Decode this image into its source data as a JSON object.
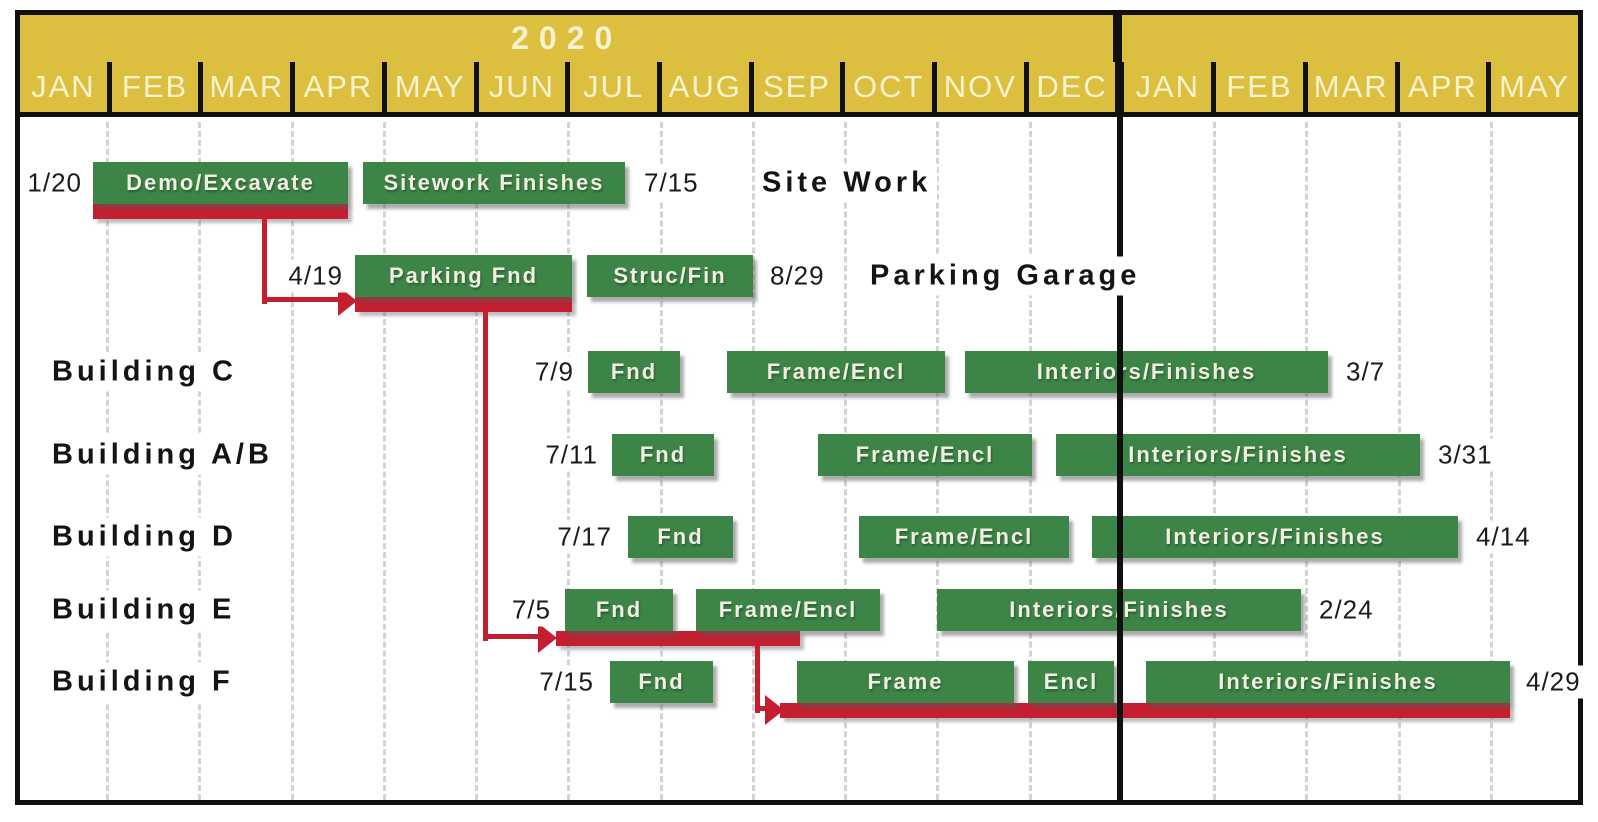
{
  "header": {
    "year1_label": "2020",
    "year2_label": "",
    "months": [
      "JAN",
      "FEB",
      "MAR",
      "APR",
      "MAY",
      "JUN",
      "JUL",
      "AUG",
      "SEP",
      "OCT",
      "NOV",
      "DEC",
      "JAN",
      "FEB",
      "MAR",
      "APR",
      "MAY"
    ]
  },
  "colors": {
    "header_bg": "#dcbf3e",
    "header_text": "#f8f2cf",
    "bar_green": "#3c8547",
    "critical_red": "#c41f30",
    "gridline_gray": "#d4d4d4",
    "ink": "#101010"
  },
  "chart_data": {
    "type": "gantt",
    "title": "Construction schedule 2020 through May of following year",
    "timeline": {
      "years": [
        {
          "label": "2020",
          "months": 12
        },
        {
          "label": "",
          "months": 5
        }
      ],
      "month_labels": [
        "JAN",
        "FEB",
        "MAR",
        "APR",
        "MAY",
        "JUN",
        "JUL",
        "AUG",
        "SEP",
        "OCT",
        "NOV",
        "DEC",
        "JAN",
        "FEB",
        "MAR",
        "APR",
        "MAY"
      ]
    },
    "gridline_x": [
      107,
      199,
      292,
      384,
      476,
      568,
      661,
      753,
      845,
      937,
      1030,
      1214,
      1306,
      1399,
      1491
    ],
    "divider_x": 1117,
    "rows": [
      {
        "title": "Site Work",
        "title_x": 756,
        "center_y": 183,
        "bar_y": 162,
        "start": {
          "text": "1/20",
          "right_x": 86
        },
        "end": {
          "text": "7/15",
          "left_x": 640
        },
        "bars": [
          {
            "label": "Demo/Excavate",
            "x": 93,
            "w": 255
          },
          {
            "label": "Sitework Finishes",
            "x": 363,
            "w": 262
          }
        ],
        "underline": {
          "x": 93,
          "w": 255,
          "y": 204
        }
      },
      {
        "title": "Parking Garage",
        "title_x": 864,
        "center_y": 276,
        "bar_y": 255,
        "start": {
          "text": "4/19",
          "right_x": 347
        },
        "end": {
          "text": "8/29",
          "left_x": 766
        },
        "bars": [
          {
            "label": "Parking Fnd",
            "x": 355,
            "w": 217
          },
          {
            "label": "Struc/Fin",
            "x": 587,
            "w": 166
          }
        ],
        "underline": {
          "x": 355,
          "w": 217,
          "y": 297
        }
      },
      {
        "title": "Building C",
        "title_x": 46,
        "center_y": 372,
        "bar_y": 351,
        "start": {
          "text": "7/9",
          "right_x": 578
        },
        "end": {
          "text": "3/7",
          "left_x": 1342
        },
        "bars": [
          {
            "label": "Fnd",
            "x": 588,
            "w": 92
          },
          {
            "label": "Frame/Encl",
            "x": 727,
            "w": 218
          },
          {
            "label": "Interiors/Finishes",
            "x": 965,
            "w": 363
          }
        ]
      },
      {
        "title": "Building A/B",
        "title_x": 46,
        "center_y": 455,
        "bar_y": 434,
        "start": {
          "text": "7/11",
          "right_x": 602
        },
        "end": {
          "text": "3/31",
          "left_x": 1434
        },
        "bars": [
          {
            "label": "Fnd",
            "x": 612,
            "w": 102
          },
          {
            "label": "Frame/Encl",
            "x": 818,
            "w": 214
          },
          {
            "label": "Interiors/Finishes",
            "x": 1056,
            "w": 364
          }
        ]
      },
      {
        "title": "Building D",
        "title_x": 46,
        "center_y": 537,
        "bar_y": 516,
        "start": {
          "text": "7/17",
          "right_x": 616
        },
        "end": {
          "text": "4/14",
          "left_x": 1472
        },
        "bars": [
          {
            "label": "Fnd",
            "x": 628,
            "w": 105
          },
          {
            "label": "Frame/Encl",
            "x": 859,
            "w": 210
          },
          {
            "label": "Interiors/Finishes",
            "x": 1092,
            "w": 366
          }
        ]
      },
      {
        "title": "Building E",
        "title_x": 46,
        "center_y": 610,
        "bar_y": 589,
        "start": {
          "text": "7/5",
          "right_x": 555
        },
        "end": {
          "text": "2/24",
          "left_x": 1315
        },
        "bars": [
          {
            "label": "Fnd",
            "x": 565,
            "w": 108
          },
          {
            "label": "Frame/Encl",
            "x": 696,
            "w": 184
          },
          {
            "label": "Interiors/Finishes",
            "x": 937,
            "w": 364
          }
        ],
        "underline": {
          "x": 556,
          "w": 244,
          "y": 631
        }
      },
      {
        "title": "Building F",
        "title_x": 46,
        "center_y": 682,
        "bar_y": 661,
        "start": {
          "text": "7/15",
          "right_x": 598
        },
        "end": {
          "text": "4/29",
          "left_x": 1522
        },
        "bars": [
          {
            "label": "Fnd",
            "x": 610,
            "w": 103
          },
          {
            "label": "Frame",
            "x": 797,
            "w": 217
          },
          {
            "label": "Encl",
            "x": 1028,
            "w": 86
          },
          {
            "label": "Interiors/Finishes",
            "x": 1146,
            "w": 364
          }
        ],
        "underline": {
          "x": 780,
          "w": 730,
          "y": 703
        }
      }
    ],
    "connectors": [
      {
        "vx": 262,
        "vy1": 218,
        "vy2": 304,
        "hx1": 262,
        "hx2": 338,
        "hy": 299,
        "tip_x": 338,
        "tip_cy": 301
      },
      {
        "vx": 483,
        "vy1": 310,
        "vy2": 641,
        "hx1": 483,
        "hx2": 538,
        "hy": 636,
        "tip_x": 538,
        "tip_cy": 638
      },
      {
        "vx": 755,
        "vy1": 644,
        "vy2": 713,
        "hx1": 755,
        "hx2": 765,
        "hy": 708,
        "tip_x": 765,
        "tip_cy": 710
      }
    ]
  }
}
